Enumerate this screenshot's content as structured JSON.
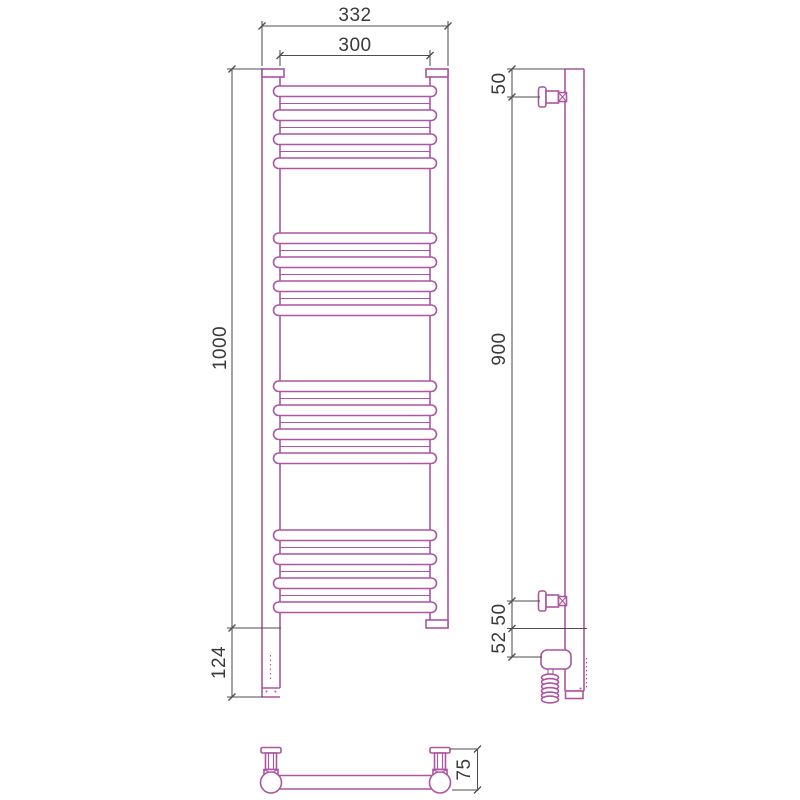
{
  "figure": "towel-rail-dimensional-drawing",
  "colors": {
    "line": "#AC55A0",
    "dim": "#4E4E4E",
    "text": "#3A3A3A",
    "bg": "#FFFFFF"
  },
  "views": {
    "front": {
      "dims": {
        "width_overall": "332",
        "width_centers": "300",
        "height": "1000",
        "bottom_ext": "124"
      }
    },
    "side": {
      "dims": {
        "bracket_top_offset": "50",
        "bracket_span": "900",
        "bracket_bottom_offset": "50",
        "element_offset": "52"
      }
    },
    "plan": {
      "dims": {
        "depth": "75"
      }
    }
  }
}
